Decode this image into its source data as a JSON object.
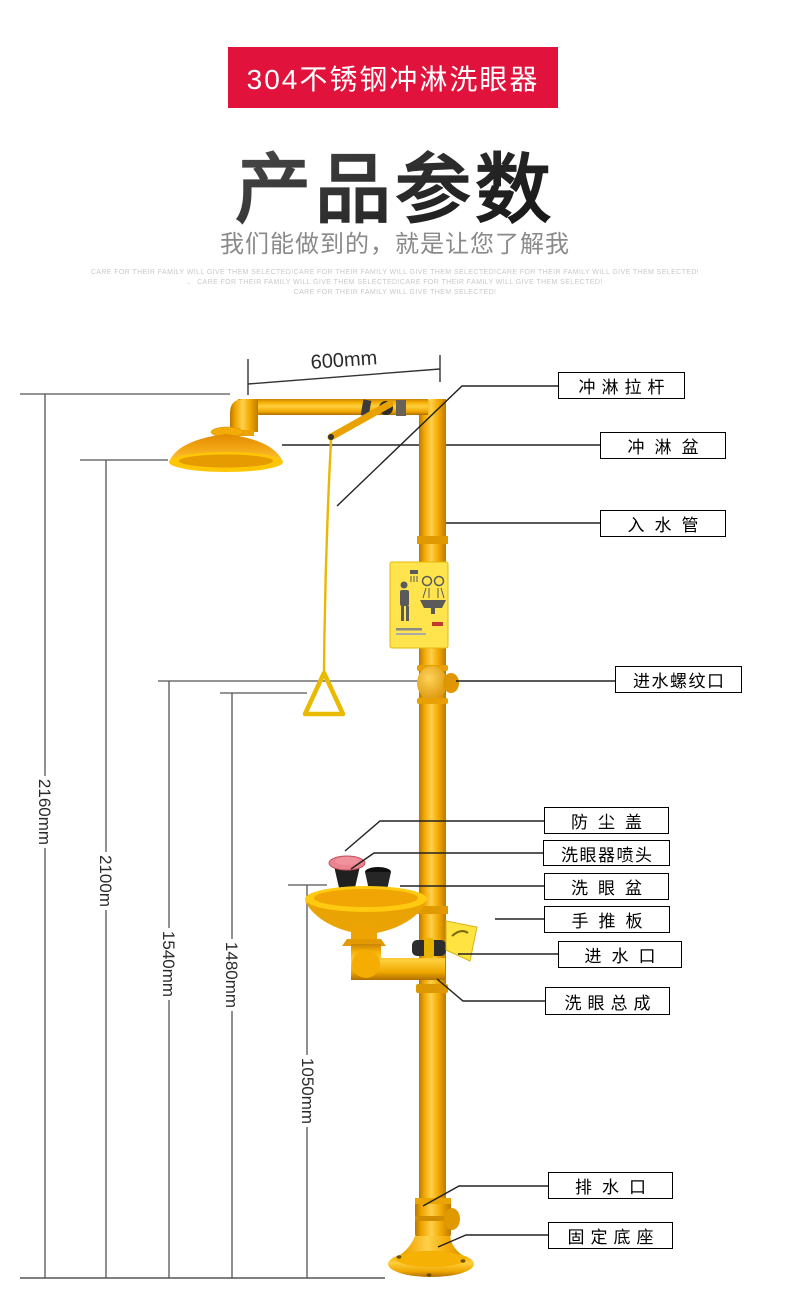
{
  "banner": {
    "text": "304不锈钢冲淋洗眼器",
    "bg_color": "#e1123b",
    "text_color": "#ffffff"
  },
  "title": {
    "text": "产品参数"
  },
  "subtitle": {
    "text": "我们能做到的，就是让您了解我"
  },
  "fine_print": {
    "line1": "CARE FOR THEIR FAMILY WILL GIVE THEM SELECTED!CARE FOR THEIR FAMILY WILL GIVE THEM SELECTED!CARE FOR THEIR FAMILY WILL GIVE THEM SELECTED!",
    "line2": "、 CARE FOR THEIR FAMILY WILL GIVE THEM SELECTED!CARE FOR THEIR FAMILY WILL GIVE THEM SELECTED!",
    "line3": "CARE FOR THEIR FAMILY WILL GIVE THEM SELECTED!"
  },
  "diagram": {
    "part_labels": [
      {
        "id": "shower-pull-rod",
        "text": "冲淋拉杆"
      },
      {
        "id": "shower-head-basin",
        "text": "冲淋盆"
      },
      {
        "id": "inlet-pipe",
        "text": "入水管"
      },
      {
        "id": "inlet-threaded-port",
        "text": "进水螺纹口"
      },
      {
        "id": "dust-cover",
        "text": "防尘盖"
      },
      {
        "id": "eyewash-spray-head",
        "text": "洗眼器喷头"
      },
      {
        "id": "eyewash-bowl",
        "text": "洗眼盆"
      },
      {
        "id": "hand-push-plate",
        "text": "手推板"
      },
      {
        "id": "water-inlet",
        "text": "进水口"
      },
      {
        "id": "eyewash-assembly",
        "text": "洗眼总成"
      },
      {
        "id": "drain-outlet",
        "text": "排水口"
      },
      {
        "id": "fixed-base",
        "text": "固定底座"
      }
    ],
    "dimensions": {
      "arm_width": "600mm",
      "total_height": "2160mm",
      "shower_head_height": "2100m",
      "inlet_port_height": "1540mm",
      "pull_handle_height": "1480mm",
      "eyewash_height": "1050mm"
    },
    "equipment": {
      "type": "combination emergency shower and eyewash station",
      "equipment_yellow": "#f2a900",
      "dust_cover_pink": "#ea8490",
      "spray_head_black": "#202020",
      "sign_plate_yellow": "#ffe44d",
      "sign_icons": [
        "shower-person-pictogram",
        "eyewash-spray-pictogram"
      ]
    }
  }
}
